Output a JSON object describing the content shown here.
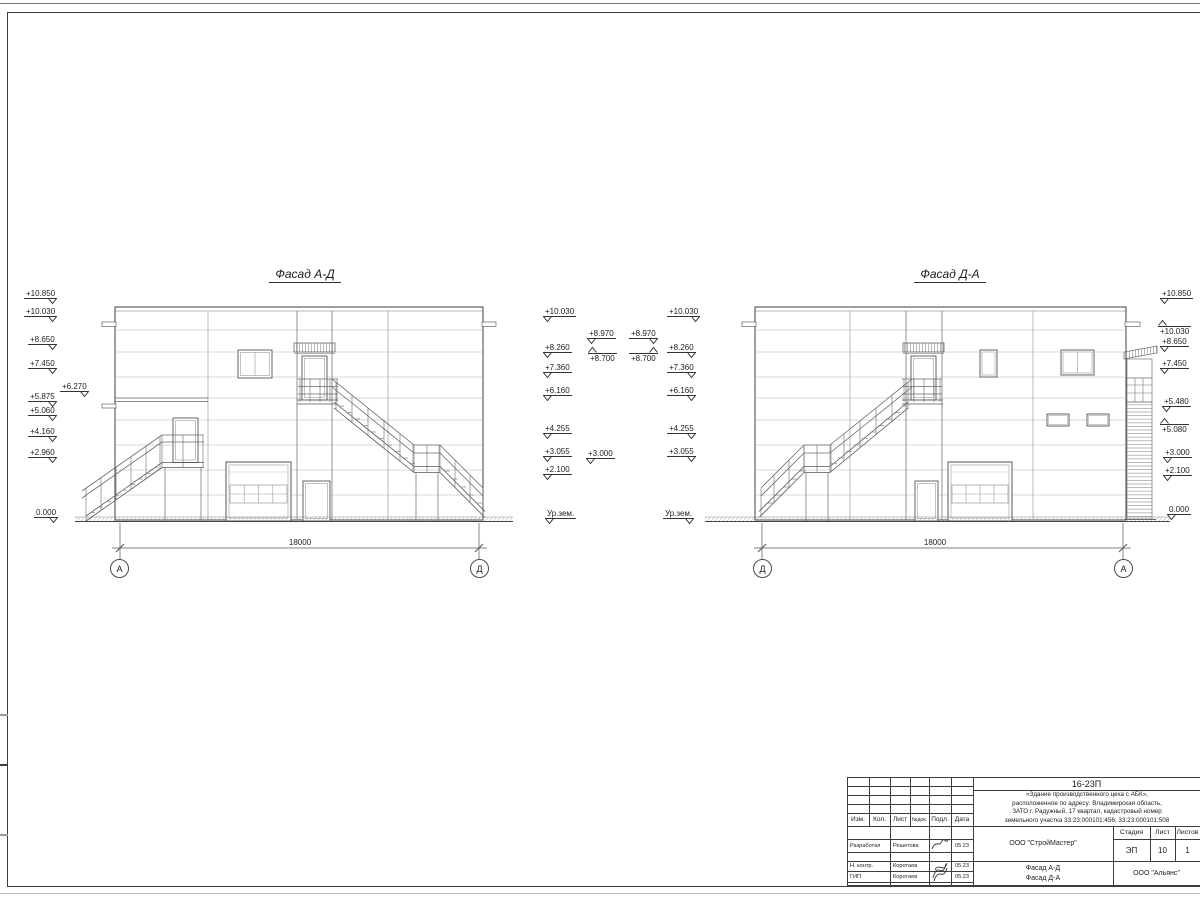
{
  "drawing": {
    "left_view": {
      "title": "Фасад А-Д",
      "dim": "18000",
      "axis_left": "А",
      "axis_right": "Д"
    },
    "right_view": {
      "title": "Фасад Д-А",
      "dim": "18000",
      "axis_left": "Д",
      "axis_right": "А"
    }
  },
  "elevation_marks": [
    {
      "t": "+10.850",
      "x": 24,
      "y": 289,
      "c": "br"
    },
    {
      "t": "+10.030",
      "x": 24,
      "y": 307,
      "c": "br"
    },
    {
      "t": "+8.650",
      "x": 28,
      "y": 335,
      "c": "br"
    },
    {
      "t": "+7.450",
      "x": 28,
      "y": 359,
      "c": "br"
    },
    {
      "t": "+6.270",
      "x": 60,
      "y": 382,
      "c": "br"
    },
    {
      "t": "+5.875",
      "x": 28,
      "y": 392,
      "c": "br"
    },
    {
      "t": "+5.060",
      "x": 28,
      "y": 406,
      "c": "br"
    },
    {
      "t": "+4.160",
      "x": 28,
      "y": 427,
      "c": "br"
    },
    {
      "t": "+2.960",
      "x": 28,
      "y": 448,
      "c": "br"
    },
    {
      "t": "0.000",
      "x": 34,
      "y": 508,
      "c": "br"
    },
    {
      "t": "+10.030",
      "x": 543,
      "y": 307,
      "c": "bl"
    },
    {
      "t": "+8.970",
      "x": 587,
      "y": 329,
      "c": "bl"
    },
    {
      "t": "+8.260",
      "x": 543,
      "y": 343,
      "c": "bl"
    },
    {
      "t": "+8.700",
      "x": 588,
      "y": 353,
      "c": "al"
    },
    {
      "t": "+7.360",
      "x": 543,
      "y": 363,
      "c": "bl"
    },
    {
      "t": "+6.160",
      "x": 543,
      "y": 386,
      "c": "bl"
    },
    {
      "t": "+4.255",
      "x": 543,
      "y": 424,
      "c": "bl"
    },
    {
      "t": "+3.055",
      "x": 543,
      "y": 447,
      "c": "bl"
    },
    {
      "t": "+3.000",
      "x": 586,
      "y": 449,
      "c": "bl"
    },
    {
      "t": "+2.100",
      "x": 543,
      "y": 465,
      "c": "bl"
    },
    {
      "t": "Ур.зем.",
      "x": 545,
      "y": 509,
      "c": "bl"
    },
    {
      "t": "+10.030",
      "x": 667,
      "y": 307,
      "c": "br"
    },
    {
      "t": "+8.970",
      "x": 629,
      "y": 329,
      "c": "br"
    },
    {
      "t": "+8.260",
      "x": 667,
      "y": 343,
      "c": "br"
    },
    {
      "t": "+8.700",
      "x": 629,
      "y": 353,
      "c": "ar"
    },
    {
      "t": "+7.360",
      "x": 667,
      "y": 363,
      "c": "br"
    },
    {
      "t": "+6.160",
      "x": 667,
      "y": 386,
      "c": "br"
    },
    {
      "t": "+4.255",
      "x": 667,
      "y": 424,
      "c": "br"
    },
    {
      "t": "+3.055",
      "x": 667,
      "y": 447,
      "c": "br"
    },
    {
      "t": "Ур.зем.",
      "x": 663,
      "y": 509,
      "c": "br"
    },
    {
      "t": "+10.850",
      "x": 1160,
      "y": 289,
      "c": "bl"
    },
    {
      "t": "+10.030",
      "x": 1158,
      "y": 326,
      "c": "al"
    },
    {
      "t": "+8.650",
      "x": 1160,
      "y": 337,
      "c": "bl"
    },
    {
      "t": "+7.450",
      "x": 1160,
      "y": 359,
      "c": "bl"
    },
    {
      "t": "+5.480",
      "x": 1162,
      "y": 397,
      "c": "bl"
    },
    {
      "t": "+5.080",
      "x": 1160,
      "y": 424,
      "c": "al"
    },
    {
      "t": "+3.000",
      "x": 1163,
      "y": 448,
      "c": "bl"
    },
    {
      "t": "+2.100",
      "x": 1163,
      "y": 466,
      "c": "bl"
    },
    {
      "t": "0.000",
      "x": 1167,
      "y": 505,
      "c": "bl"
    }
  ],
  "title_block": {
    "doc_number": "16-23П",
    "project_line1": "«Здание производственного цеха с АБК»,",
    "project_line2": "расположенное по адресу: Владимирская область,",
    "project_line3": "ЗАТО г. Радужный, 17 квартал, кадастровый номер",
    "project_line4": "земельного участка 33:23:000101:456, 33:23:000101:508",
    "col_izm": "Изм.",
    "col_kol": "Кол.",
    "col_list": "Лист",
    "col_ndok": "№док.",
    "col_podp": "Подл.",
    "col_data": "Дата",
    "rows": [
      {
        "role": "Разработал",
        "name": "Решетова",
        "date": "05.23"
      },
      {
        "role": "Н. контр.",
        "name": "Коротаев",
        "date": "05.23"
      },
      {
        "role": "ГИП",
        "name": "Коротаев",
        "date": "05.23"
      }
    ],
    "stage_label": "Стадия",
    "sheet_label": "Лист",
    "sheets_label": "Листов",
    "stage": "ЭП",
    "sheet": "10",
    "sheets": "1",
    "org1": "ООО \"СтройМастер\"",
    "drawing_title_line1": "Фасад А-Д",
    "drawing_title_line2": "Фасад Д-А",
    "org2": "ООО \"Альянс\""
  },
  "colors": {
    "line_main": "#3c3c3c",
    "line_light": "#b5b5b5",
    "paper": "#ffffff"
  }
}
